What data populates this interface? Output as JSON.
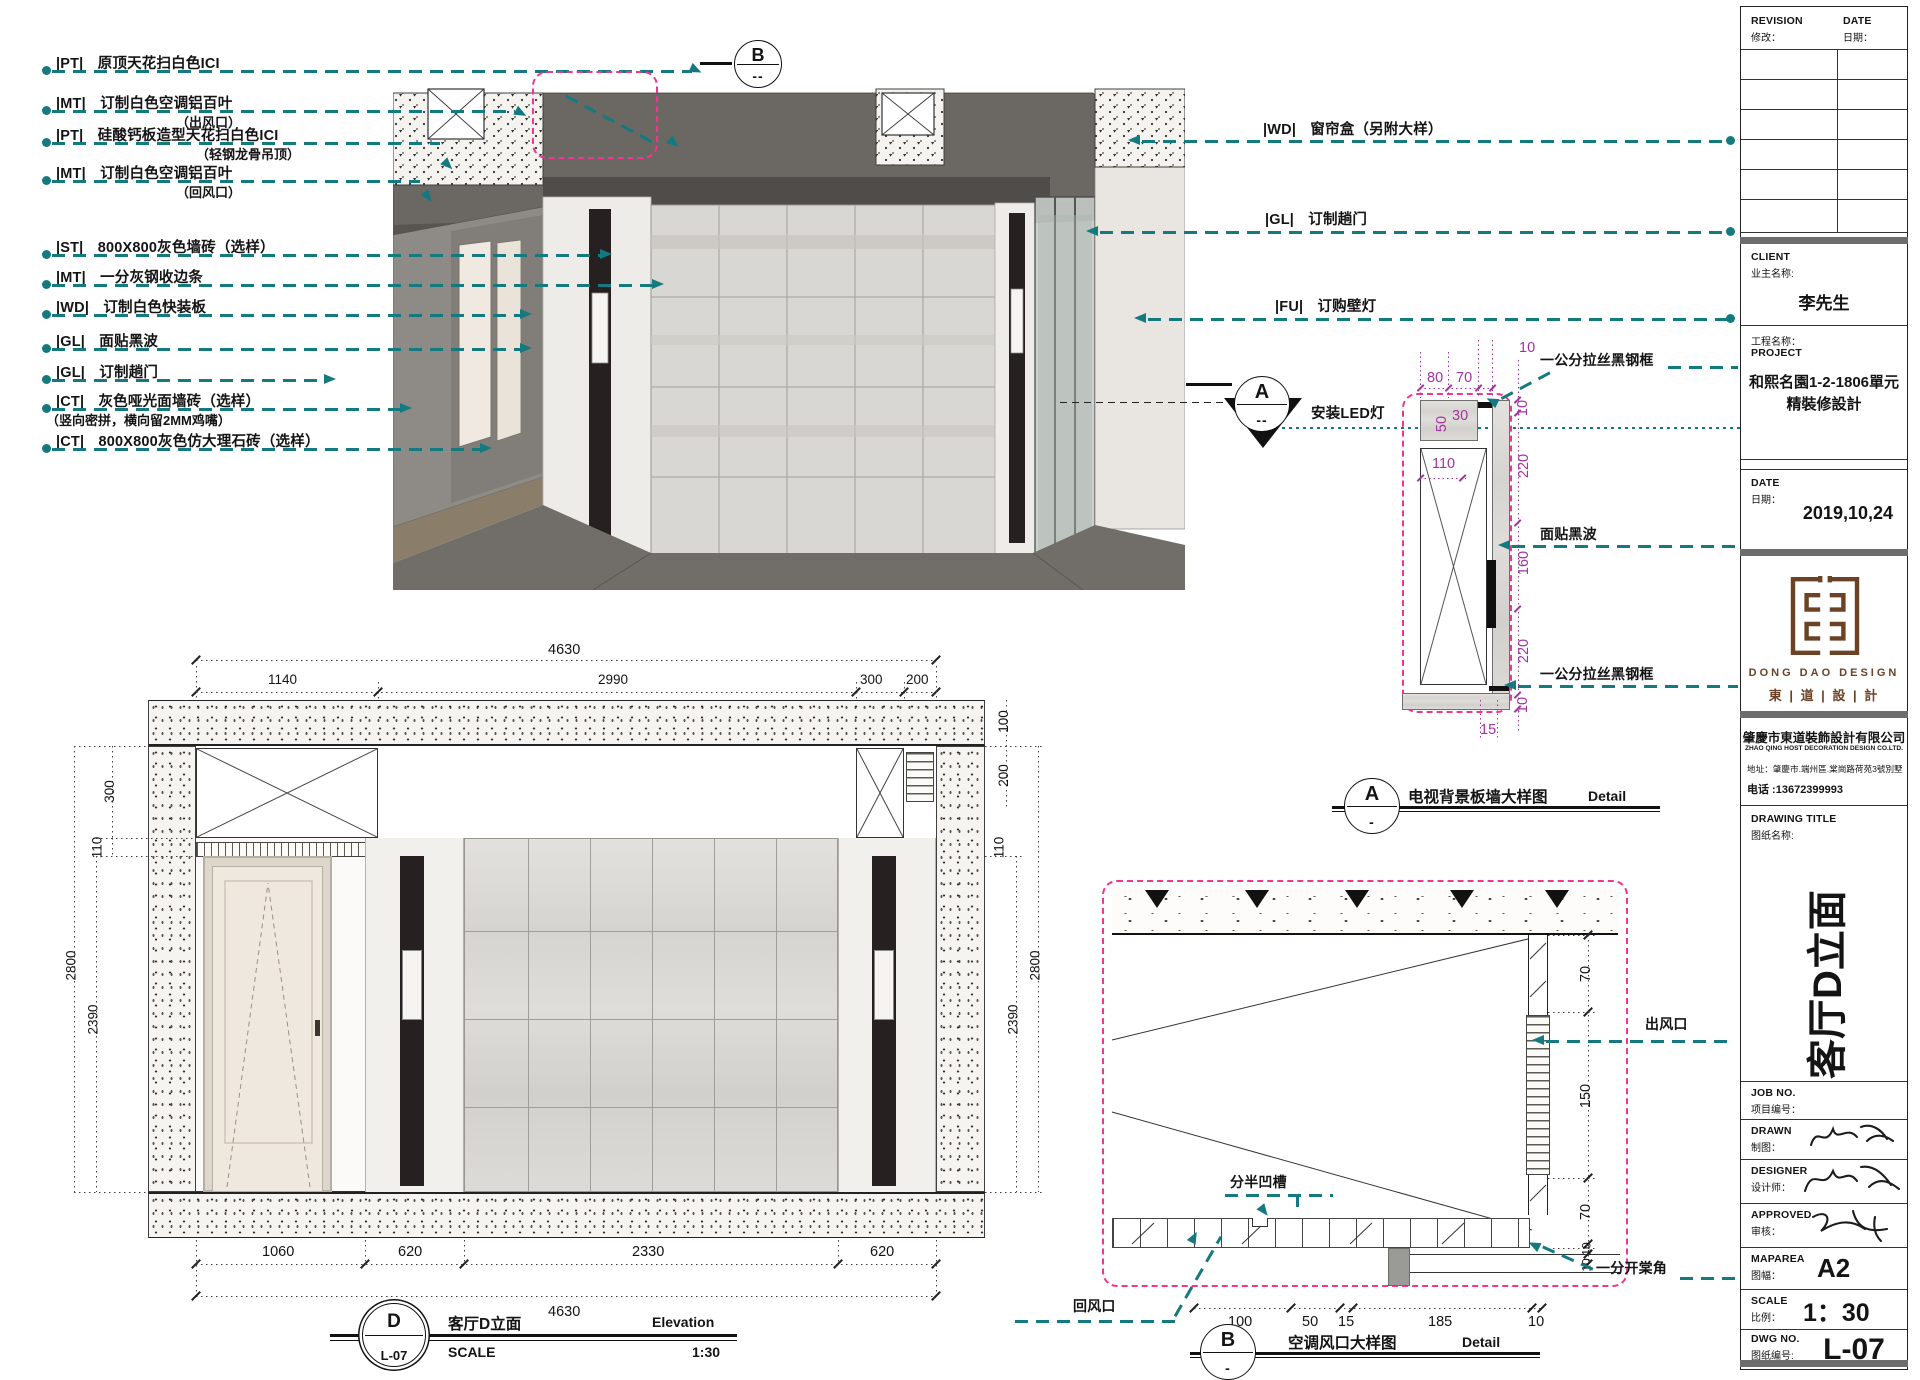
{
  "colors": {
    "teal": "#147a80",
    "pink": "#f0368f",
    "purple": "#a232a2",
    "brown": "#6b4226"
  },
  "callouts_left": [
    {
      "tag": "|PT|",
      "text": "原顶天花扫白色ICI",
      "sub": ""
    },
    {
      "tag": "|MT|",
      "text": "订制白色空调铝百叶",
      "sub": "（出风口）"
    },
    {
      "tag": "|PT|",
      "text": "硅酸钙板造型天花扫白色ICI",
      "sub": "（轻钢龙骨吊顶）"
    },
    {
      "tag": "|MT|",
      "text": "订制白色空调铝百叶",
      "sub": "（回风口）"
    },
    {
      "tag": "|ST|",
      "text": "800X800灰色墙砖（选样）",
      "sub": ""
    },
    {
      "tag": "|MT|",
      "text": "一分灰钢收边条",
      "sub": ""
    },
    {
      "tag": "|WD|",
      "text": "订制白色快装板",
      "sub": ""
    },
    {
      "tag": "|GL|",
      "text": "面贴黑波",
      "sub": ""
    },
    {
      "tag": "|GL|",
      "text": "订制趟门",
      "sub": ""
    },
    {
      "tag": "|CT|",
      "text": "灰色哑光面墙砖（选样）",
      "sub": "（竖向密拼，横向留2MM鸡嘴）"
    },
    {
      "tag": "|CT|",
      "text": "800X800灰色仿大理石砖（选样）",
      "sub": ""
    }
  ],
  "callouts_right": [
    {
      "tag": "|WD|",
      "text": "窗帘盒（另附大样）"
    },
    {
      "tag": "|GL|",
      "text": "订制趟门"
    },
    {
      "tag": "|FU|",
      "text": "订购壁灯"
    },
    {
      "tag": "",
      "text": "安装LED灯"
    }
  ],
  "markers": {
    "a": {
      "letter": "A",
      "sub": "--"
    },
    "b": {
      "letter": "B",
      "sub": "--"
    }
  },
  "detail_a": {
    "labels": {
      "frame_top": "一公分拉丝黑钢框",
      "glass": "面贴黑波",
      "frame_bottom": "一公分拉丝黑钢框"
    },
    "dims": {
      "d10t": "10",
      "d80": "80",
      "d70": "70",
      "d50": "50",
      "d30": "30",
      "d110": "110",
      "right": [
        "10",
        "220",
        "160",
        "220",
        "10"
      ],
      "d15": "15"
    },
    "title": {
      "letter": "A",
      "sub": "-",
      "name": "电视背景板墙大样图",
      "type_label": "Detail"
    }
  },
  "detail_b": {
    "labels": {
      "outlet": "出风口",
      "groove": "分半凹槽",
      "return_air": "回风口",
      "corner": "一分开棠角"
    },
    "dims": {
      "right": [
        "70",
        "150",
        "70",
        "10",
        "10"
      ],
      "bottom": [
        "100",
        "50",
        "15",
        "185",
        "10"
      ]
    },
    "title": {
      "letter": "B",
      "sub": "-",
      "name": "空调风口大样图",
      "type_label": "Detail"
    }
  },
  "elevation": {
    "dims_top_total": "4630",
    "dims_top": [
      "1140",
      "2990",
      "300",
      "200"
    ],
    "dims_left": [
      "300",
      "110",
      "2800",
      "2390"
    ],
    "dims_right": [
      "100",
      "200",
      "110",
      "2800",
      "2390"
    ],
    "dims_bottom": [
      "1060",
      "620",
      "2330",
      "620"
    ],
    "dims_bottom_total": "4630",
    "title": {
      "letter": "D",
      "sheet": "L-07",
      "name": "客厅D立面",
      "type_label": "Elevation",
      "scale_label": "SCALE",
      "scale": "1:30"
    }
  },
  "titleblock": {
    "revision": {
      "en": "REVISION",
      "zh": "修改：",
      "date_en": "DATE",
      "date_zh": "日期："
    },
    "client": {
      "en": "CLIENT",
      "zh": "业主名称:",
      "value": "李先生"
    },
    "project": {
      "zh": "工程名称：",
      "en": "PROJECT",
      "line1": "和熙名園1-2-1806單元",
      "line2": "精裝修設計"
    },
    "date": {
      "en": "DATE",
      "zh": "日期：",
      "value": "2019,10,24"
    },
    "logo": {
      "en": "DONG DAO DESIGN",
      "zh": "東 | 道 | 設 | 計"
    },
    "company": {
      "name": "肇慶市東道裝飾設計有限公司",
      "name_en": "ZHAO QING HOST DECORATION DESIGN CO.LTD.",
      "address": "地址：肇慶市.端州區.棠崗路荷苑3號別墅",
      "phone": "电话 :13672399993"
    },
    "drawing_title": {
      "en": "DRAWING TITLE",
      "zh": "图纸名称:",
      "value": "客厅D立面"
    },
    "job": {
      "en": "JOB NO.",
      "zh": "项目编号："
    },
    "drawn": {
      "en": "DRAWN",
      "zh": "制图："
    },
    "designer": {
      "en": "DESIGNER",
      "zh": "设计师："
    },
    "approved": {
      "en": "APPROVED",
      "zh": "审核："
    },
    "maparea": {
      "en": "MAPAREA",
      "zh": "图幅：",
      "value": "A2"
    },
    "scale": {
      "en": "SCALE",
      "zh": "比例：",
      "value": "1：30"
    },
    "dwg": {
      "en": "DWG NO.",
      "zh": "图纸编号:",
      "value": "L-07"
    }
  }
}
